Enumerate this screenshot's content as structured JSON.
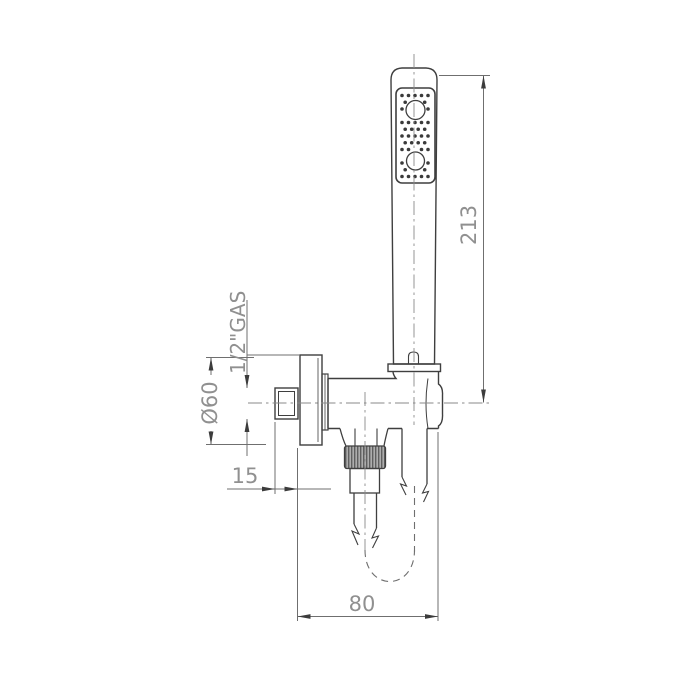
{
  "page": {
    "background": "#ffffff"
  },
  "drawing": {
    "type": "technical-diagram",
    "subject": "hand shower set with wall bracket, water inlet and flexible hose",
    "line_color": "#3f3f3f",
    "dim_line_color": "#6f6f6f",
    "dim_text_color": "#909090",
    "nut_fill": "#adadad",
    "dimensions": {
      "hose_height": "213",
      "bracket_depth": "80",
      "offset": "15",
      "flange_diameter": "Ø60",
      "thread_size": "1/2\"GAS"
    }
  }
}
